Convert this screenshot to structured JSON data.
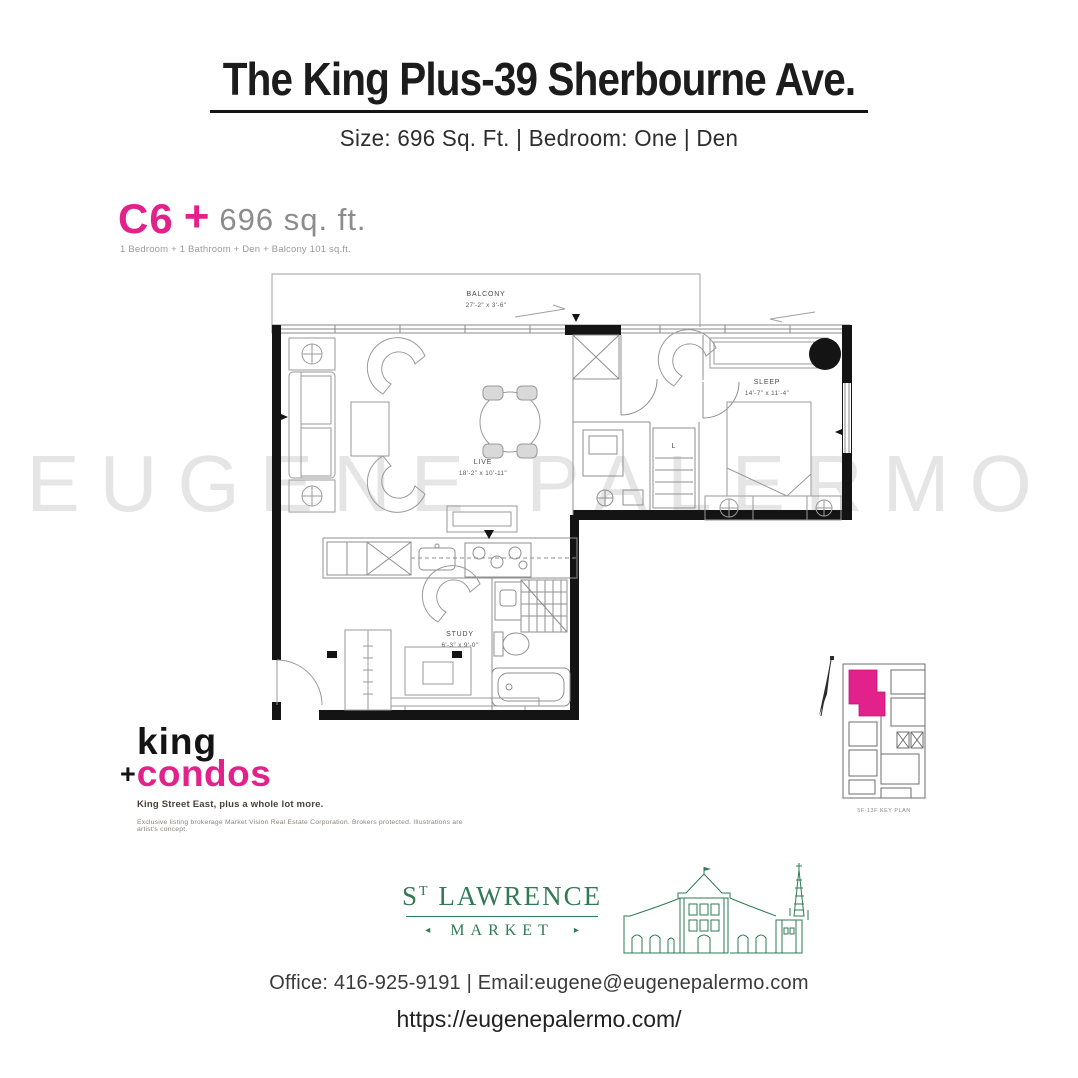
{
  "page": {
    "title": "The King Plus-39 Sherbourne Ave.",
    "subtitle": "Size: 696 Sq. Ft. |  Bedroom: One  | Den"
  },
  "unit": {
    "code": "C6",
    "plus": "+",
    "size": "696 sq. ft.",
    "description": "1 Bedroom + 1 Bathroom + Den + Balcony 101 sq.ft."
  },
  "floorplan": {
    "balcony": {
      "label": "BALCONY",
      "dims": "27'-2\" x 3'-6\""
    },
    "live": {
      "label": "LIVE",
      "dims": "18'-2\" x 10'-11\""
    },
    "sleep": {
      "label": "SLEEP",
      "dims": "14'-7\" x 11'-4\""
    },
    "study": {
      "label": "STUDY",
      "dims": "6'-3\" x 9'-0\""
    },
    "linen": "L"
  },
  "watermark": "EUGENE PALERMO",
  "brand": {
    "king": "king",
    "plus": "+",
    "condos": "condos",
    "tagline": "King Street East, plus a whole lot more.",
    "disclaimer": "Exclusive listing brokerage Market Vision Real Estate Corporation. Brokers protected. Illustrations are artist's concept."
  },
  "keyplan": {
    "caption": "5F-13F KEY PLAN"
  },
  "market": {
    "st": "S",
    "t": "T",
    "rest": " LAWRENCE",
    "sub": "MARKET",
    "left_arrow": "◂",
    "right_arrow": "▸"
  },
  "footer": {
    "office_line": "Office: 416-925-9191  |  Email:eugene@eugenepalermo.com",
    "website": "https://eugenepalermo.com/"
  },
  "colors": {
    "pink": "#e3218b",
    "green": "#2e7b54",
    "watermark": "#e5e5e5"
  }
}
